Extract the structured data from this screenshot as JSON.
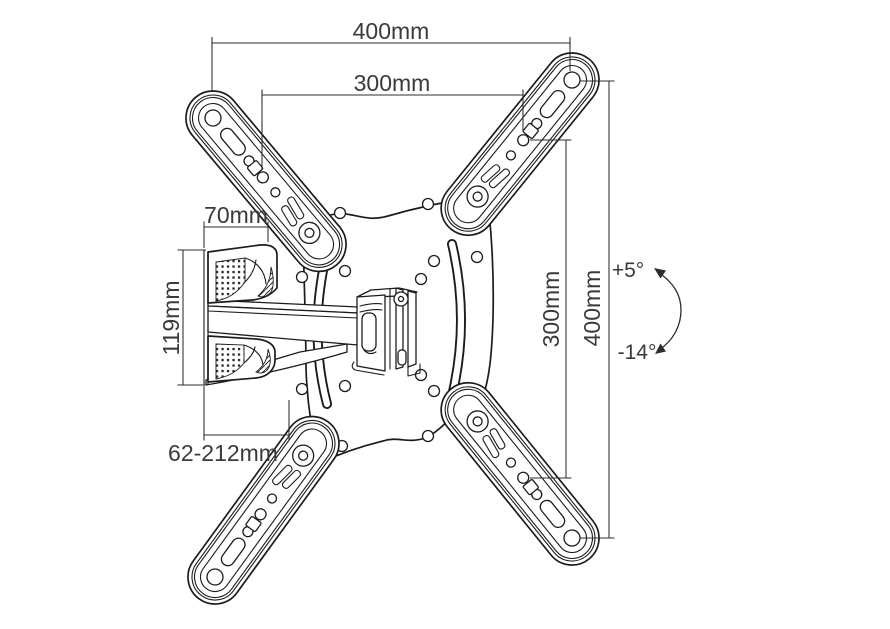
{
  "diagram": {
    "type": "technical-drawing",
    "subject": "Articulating TV wall mount - dimensional diagram",
    "background": "#ffffff",
    "line_color": "#1c1c1c",
    "labels": {
      "top_width_outer": "400mm",
      "top_width_inner": "300mm",
      "wall_plate_width": "70mm",
      "wall_plate_height": "119mm",
      "extension_range": "62-212mm",
      "right_height_inner": "300mm",
      "right_height_outer": "400mm",
      "tilt_up": "+5°",
      "tilt_down": "-14°"
    }
  }
}
